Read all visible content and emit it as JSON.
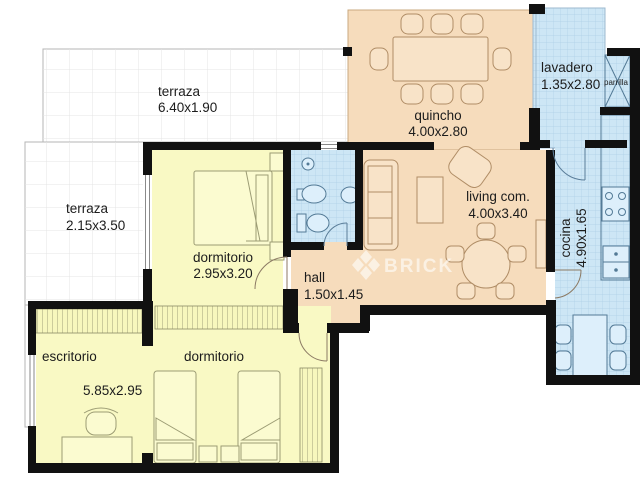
{
  "watermark": {
    "brand": "BRICK",
    "logo": "brick-diamond-logo"
  },
  "rooms": {
    "terraza_top": {
      "name": "terraza",
      "dims": "6.40x1.90"
    },
    "terraza_left": {
      "name": "terraza",
      "dims": "2.15x3.50"
    },
    "quincho": {
      "name": "quincho",
      "dims": "4.00x2.80"
    },
    "lavadero": {
      "name": "lavadero",
      "dims": "1.35x2.80"
    },
    "parrilla": {
      "name": "parrilla"
    },
    "living": {
      "name": "living com.",
      "dims": "4.00x3.40"
    },
    "cocina": {
      "name": "cocina",
      "dims": "4.90x1.65"
    },
    "dormitorio_principal": {
      "name": "dormitorio",
      "dims": "2.95x3.20"
    },
    "hall": {
      "name": "hall",
      "dims": "1.50x1.45"
    },
    "escritorio": {
      "name": "escritorio",
      "dims": "5.85x2.95"
    },
    "dormitorio_secundario": {
      "name": "dormitorio"
    }
  },
  "colors": {
    "wall": "#111111",
    "peach_room": "#f6dcbc",
    "yellow_room": "#f9f9c4",
    "blue_room": "#cde6f5",
    "blue_tile_line": "#aecfe6",
    "terrace_grid": "#e4e4e4",
    "label_text": "#1c1c1c",
    "watermark": "#ffffff"
  }
}
